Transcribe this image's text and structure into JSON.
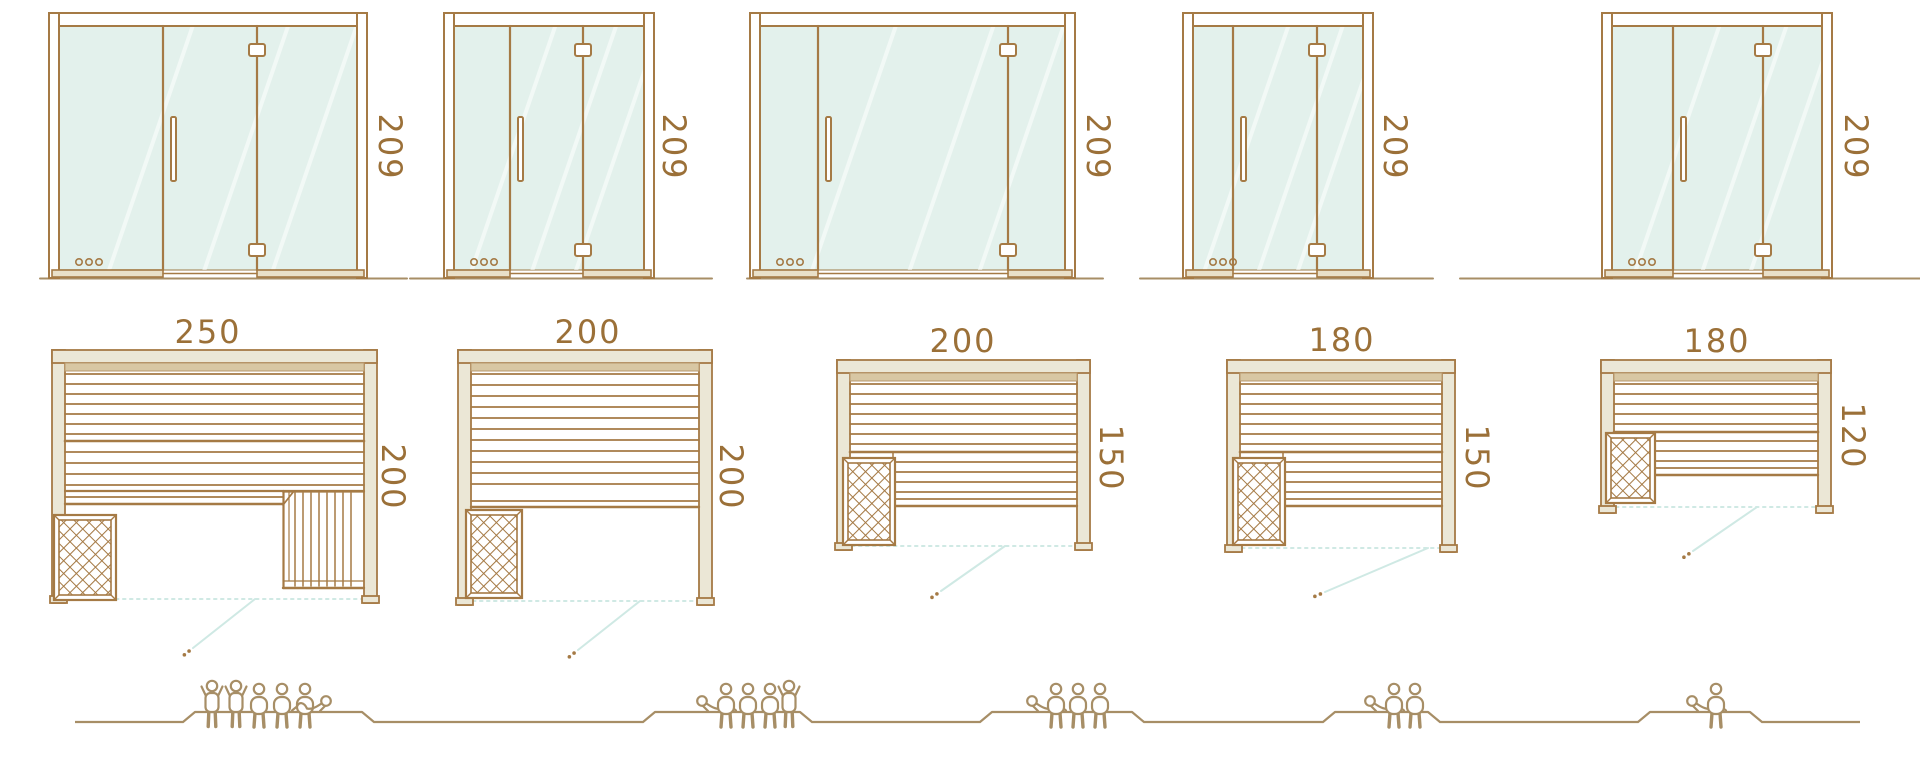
{
  "palette": {
    "line": "#a57a45",
    "text": "#9b7038",
    "glass": "#e3f1ec",
    "cream": "#ebe7d6",
    "band": "#d8c7a3",
    "teal": "#cfe9e4",
    "people": "#a78e66",
    "rail": "#e9e0c9",
    "white": "#ffffff"
  },
  "columns": [
    {
      "door": {
        "height_label": "209",
        "height": 209
      },
      "plan": {
        "width_label": "250",
        "depth_label": "200",
        "width": 250,
        "depth": 200
      },
      "capacity": {
        "total": 6,
        "standing": 2,
        "sitting": 3,
        "lying": 1,
        "figures": [
          "standing",
          "standing",
          "sitting",
          "sitting",
          "sitting",
          "lying"
        ]
      }
    },
    {
      "door": {
        "height_label": "209",
        "height": 209
      },
      "plan": {
        "width_label": "200",
        "depth_label": "200",
        "width": 200,
        "depth": 200
      },
      "capacity": {
        "total": 5,
        "standing": 1,
        "sitting": 3,
        "lying": 1,
        "figures": [
          "lying",
          "sitting",
          "sitting",
          "sitting",
          "standing"
        ]
      }
    },
    {
      "door": {
        "height_label": "209",
        "height": 209
      },
      "plan": {
        "width_label": "200",
        "depth_label": "150",
        "width": 200,
        "depth": 150
      },
      "capacity": {
        "total": 4,
        "standing": 0,
        "sitting": 3,
        "lying": 1,
        "figures": [
          "lying",
          "sitting",
          "sitting",
          "sitting"
        ]
      }
    },
    {
      "door": {
        "height_label": "209",
        "height": 209
      },
      "plan": {
        "width_label": "180",
        "depth_label": "150",
        "width": 180,
        "depth": 150
      },
      "capacity": {
        "total": 3,
        "standing": 0,
        "sitting": 2,
        "lying": 1,
        "figures": [
          "lying",
          "sitting",
          "sitting"
        ]
      }
    },
    {
      "door": {
        "height_label": "209",
        "height": 209
      },
      "plan": {
        "width_label": "180",
        "depth_label": "120",
        "width": 180,
        "depth": 120
      },
      "capacity": {
        "total": 2,
        "standing": 0,
        "sitting": 1,
        "lying": 1,
        "figures": [
          "lying",
          "sitting"
        ]
      }
    }
  ]
}
